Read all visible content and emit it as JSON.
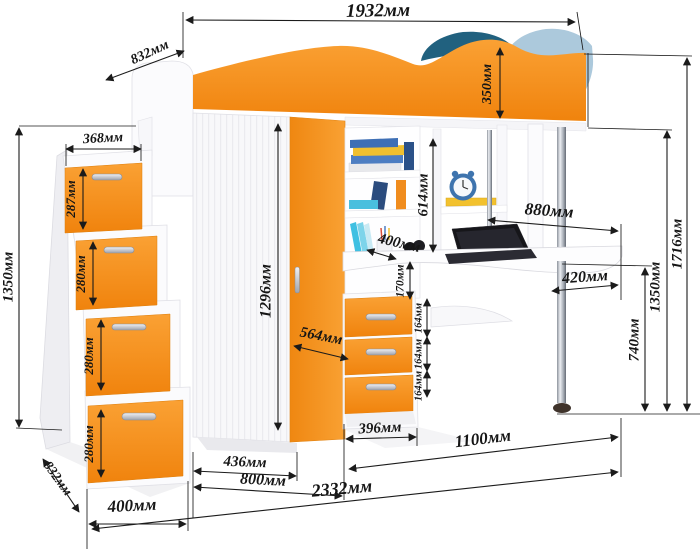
{
  "figure": {
    "unit": "мм",
    "colors": {
      "accent_orange": "#F5921E",
      "orange_dark": "#EE820C",
      "pillow_blue": "#21617F",
      "blanket_blue": "#ACC9DC",
      "dimension_ink": "#1B1B1B"
    }
  },
  "dims": {
    "bed_length": "1932мм",
    "bed_depth": "832мм",
    "bed_rail_height": "350мм",
    "stairs_top_width": "368мм",
    "stair_step_1": "287мм",
    "stair_step_2": "280мм",
    "stair_step_3": "280мм",
    "stair_step_4": "280мм",
    "stairs_height": "1350мм",
    "wardrobe_door_height": "1296мм",
    "wardrobe_depth": "564мм",
    "shelf_depth": "400мм",
    "shelf_gap": "170мм",
    "drawer_1": "164мм",
    "drawer_2": "164мм",
    "drawer_3": "164мм",
    "hutch_height": "614мм",
    "desk_length": "880мм",
    "desk_corner": "420мм",
    "desk_height": "740мм",
    "underbed_height": "1350мм",
    "total_height": "1716мм",
    "drawer_unit_width": "396мм",
    "desk_span": "1100мм",
    "wardrobe_section_a": "436мм",
    "wardrobe_section_b": "800мм",
    "total_width": "2332мм",
    "stairs_width": "400мм",
    "stairs_depth": "832мм"
  }
}
